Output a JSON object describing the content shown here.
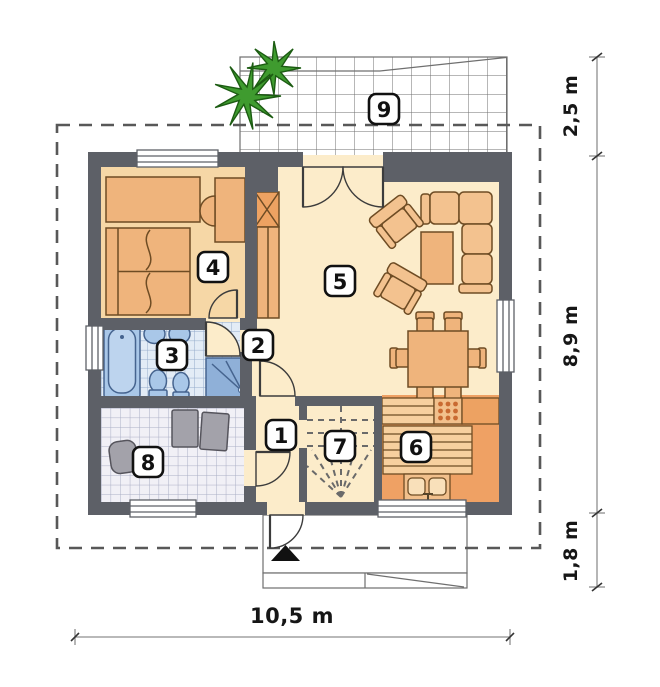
{
  "rooms": {
    "r1": {
      "label": "1"
    },
    "r2": {
      "label": "2"
    },
    "r3": {
      "label": "3"
    },
    "r4": {
      "label": "4"
    },
    "r5": {
      "label": "5"
    },
    "r6": {
      "label": "6"
    },
    "r7": {
      "label": "7"
    },
    "r8": {
      "label": "8"
    },
    "r9": {
      "label": "9"
    }
  },
  "dimensions": {
    "right_top": "2,5 m",
    "right_middle": "8,9 m",
    "right_bottom": "1,8 m",
    "bottom": "10,5 m"
  },
  "colors": {
    "wall": "#5d6067",
    "floor_cream": "#fcecca",
    "floor_bedroom": "#f6d7a6",
    "floor_kitchen": "#efa164",
    "counter_light": "#f7d09f",
    "furniture": "#efb47c",
    "furniture_dark": "#eda262",
    "sofa": "#f3c28f",
    "outline_brown": "#6e4c24",
    "tile_bath_bg": "#e3ecf6",
    "tile_bath_line": "#93aacb",
    "tile_util_bg": "#f1f0f6",
    "tile_util_line": "#a9adc4",
    "fixture_blue": "#a9c7e8",
    "fixture_blue_deep": "#8fb0d8",
    "fixture_outline": "#46648f",
    "appliance_gray": "#a3a2aa",
    "plant_green": "#3f9b2f",
    "plant_dark": "#1c5c12",
    "boundary_gray": "#585858",
    "dim_gray": "#8f8f8f",
    "stove_dot": "#c96a32"
  }
}
